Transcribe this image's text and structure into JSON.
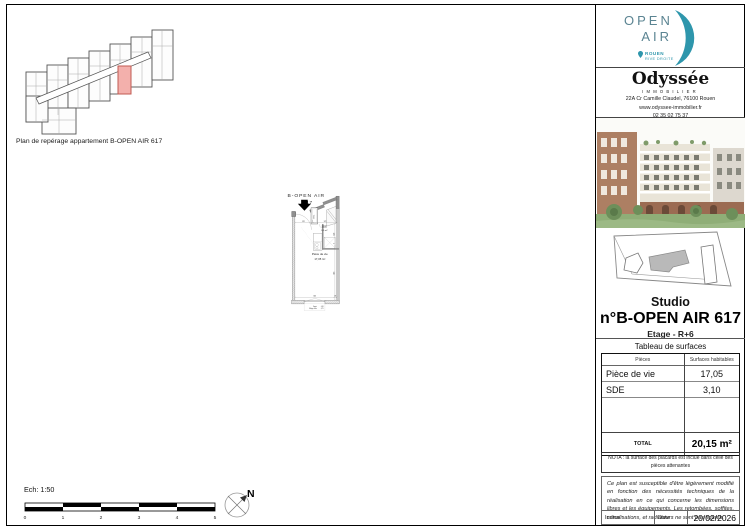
{
  "page": {
    "key_plan_caption": "Plan de repérage appartement B-OPEN AIR 617",
    "scale_label": "Ech: 1:50"
  },
  "main_plan": {
    "title": "B-OPEN AIR",
    "unit_number": "617",
    "etel_label": "ETEL",
    "sde_name": "SDE",
    "sde_area": "3,1 m²",
    "living_name": "Pièce de vie",
    "living_area": "17,05 m²",
    "dims": {
      "top": [
        "122",
        "7",
        "172"
      ],
      "right": [
        "158",
        "7",
        "456"
      ],
      "bottom": [
        "301",
        "18"
      ]
    },
    "window_note": {
      "appui_label": "Appui",
      "appui_value": "0,36",
      "allege_label": "Allège vitrée",
      "allege_value": "0,75"
    }
  },
  "scale_bar": {
    "ticks": [
      "0",
      "1",
      "2",
      "3",
      "4",
      "5"
    ]
  },
  "north_label": "N",
  "sidebar": {
    "openair": {
      "word1": "OPEN",
      "word2": "AIR",
      "city": "ROUEN",
      "district": "RIVE DROITE"
    },
    "agency": {
      "name": "Odyssée",
      "subtitle": "IMMOBILIER",
      "address": "22A Cr Camille Claudel, 76100 Rouen",
      "website": "www.odyssee-immobilier.fr",
      "phone": "02 35 02 75 37"
    },
    "unit": {
      "type": "Studio",
      "name": "n°B-OPEN AIR 617",
      "floor": "Etage - R+6"
    },
    "table": {
      "title": "Tableau de surfaces",
      "col_pieces": "Pièces",
      "col_surfaces": "Surfaces habitables",
      "rows": [
        {
          "piece": "Pièce de vie",
          "surface": "17,05"
        },
        {
          "piece": "SDE",
          "surface": "3,10"
        }
      ],
      "total_label": "TOTAL",
      "total_value": "20,15 m²"
    },
    "nota": "NOTA : la surface des placards est inclue dans celle des pièces attenantes",
    "legal": "Ce plan est susceptible d'être légèrement modifié en fonction des nécessités techniques de la réalisation en ce qui concerne les dimensions libres et les équipements. Les retombées, soffites, canalisations, et radiateurs ne sont pas figurés.",
    "footer": {
      "indice_label": "Indice :",
      "date_label": "Date :",
      "date_value": "20/02/2026"
    }
  },
  "colors": {
    "accent_teal": "#2e96ac",
    "wall_gray": "#909090",
    "highlight_pink": "#f3b0ac"
  }
}
